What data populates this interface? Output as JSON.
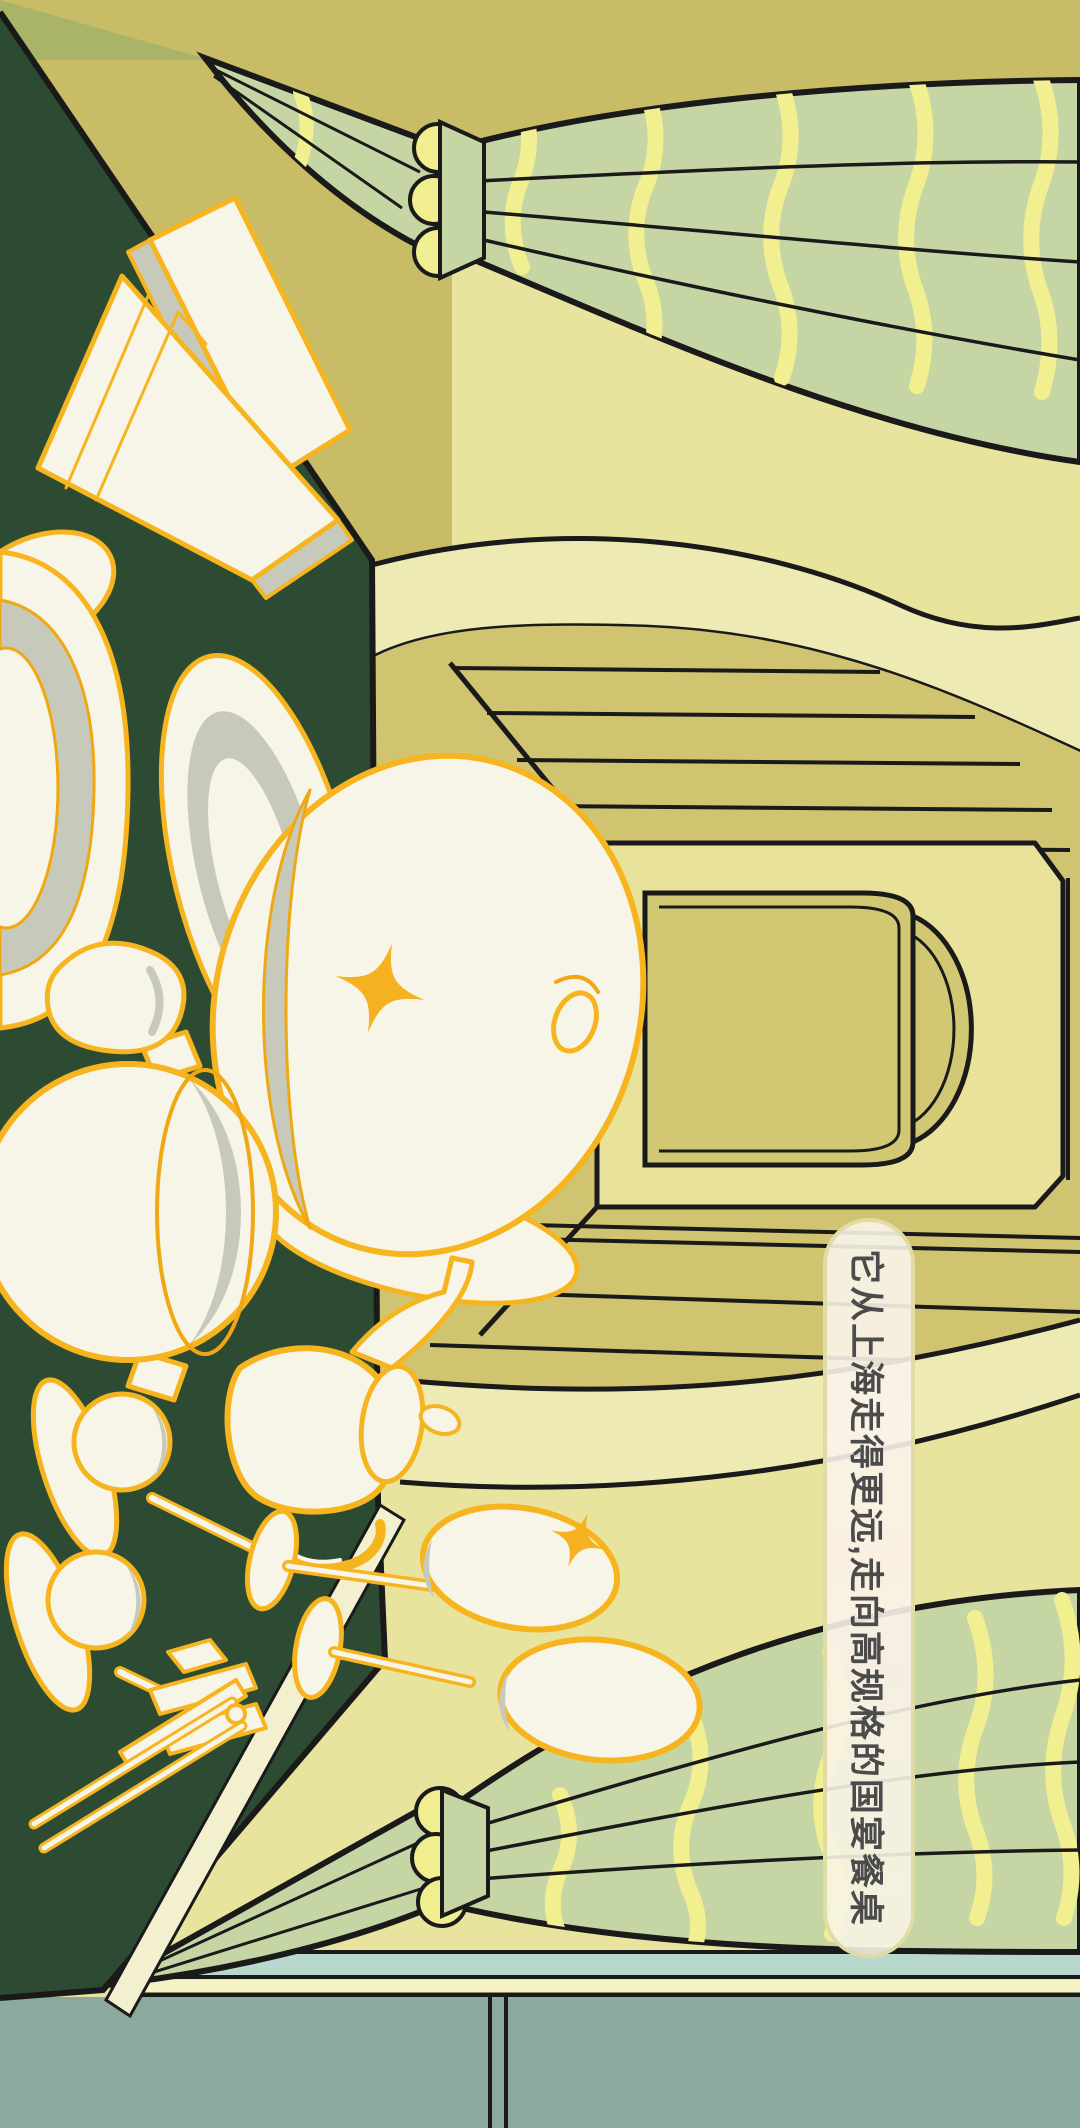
{
  "meta": {
    "type": "illustration",
    "orientation": "landscape artwork rotated 90deg clockwise",
    "canvas": {
      "width": 1080,
      "height": 2128
    }
  },
  "caption": {
    "text": "它从上海走得更远,走向高规格的国宴餐桌",
    "reading": "top-to-bottom, glyphs rotated 90deg clockwise"
  },
  "bubble": {
    "shape": "pill",
    "background": "#faf6ee",
    "border_color": "#dfdaa2",
    "text_color": "#4b4b4b",
    "opacity": 0.9
  },
  "palette": {
    "table_green": "#2d4a33",
    "wall_olive": "#c9bc66",
    "wall_pale": "#e8e49d",
    "corner_sliver_green": "#a9b469",
    "band_cream": "#edeab4",
    "ceiling_olive": "#d0c471",
    "door_wall": "#e8e29b",
    "door_face": "#d2c873",
    "curtain_green": "#c6d5a4",
    "curtain_stripe_yellow": "#f2ef90",
    "tie_bump_yellow": "#f0ee8e",
    "porcelain_white": "#f7f5e8",
    "porcelain_shadow": "#c7cabb",
    "outline_orange": "#f6b51f",
    "outline_orange_thin": "#f0a714",
    "sparkle_orange": "#f5b120",
    "baseboard_teal": "#b9d8cd",
    "baseboard_yellow": "#f5f2c3",
    "floor_slate": "#8ba99c",
    "line_black": "#1a1a1a",
    "table_skirt": "#f2f0cf"
  },
  "scene": {
    "description": "Stylized banquet-hall interior seen in one-point perspective with an arched doorway, striped ceiling and floor boards, leaf-shaped tied curtains, and a dark-green banquet table set with white-and-gold tableware.",
    "elements": [
      "banquet-table",
      "menu-books",
      "lotus-dish",
      "serving-plate",
      "domed-tureen",
      "stockpot",
      "sauce-boat",
      "coffee-pot",
      "teacup-and-saucer",
      "champagne-flutes",
      "chopsticks",
      "chopstick-rest",
      "doorway",
      "door-arch",
      "ceiling-boards",
      "floor-boards",
      "cream-arch-band",
      "top-curtain",
      "bottom-curtain",
      "baseboard-strips",
      "slate-floor",
      "sparkles",
      "caption-bubble"
    ]
  }
}
